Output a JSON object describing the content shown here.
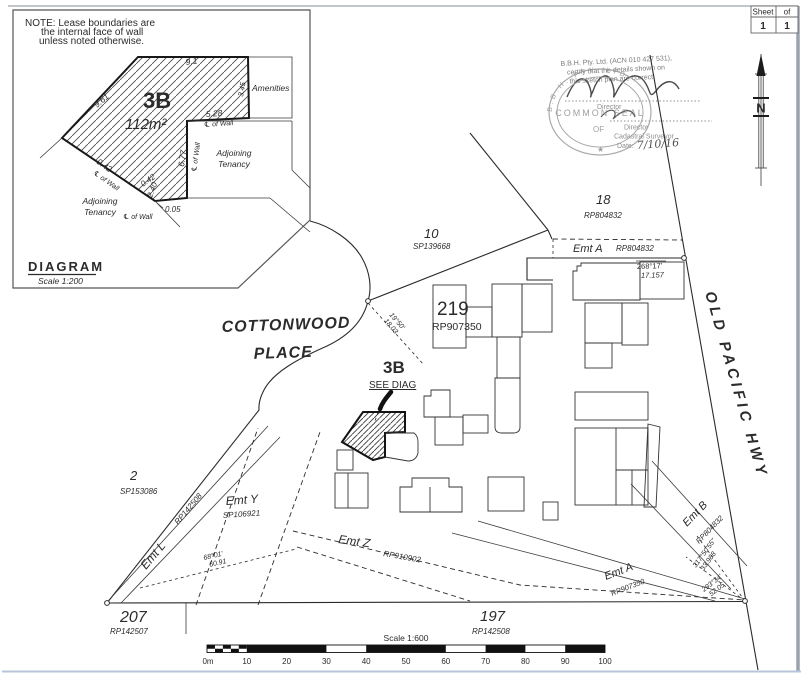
{
  "colors": {
    "drawing_line": "#2b2b2b",
    "stamp_gray": "#8f8f8f",
    "frame_gray": "#9aa3ad",
    "frame_blue": "#b9c6da"
  },
  "sheet": {
    "header1": "Sheet",
    "header2": "of",
    "value1": "1",
    "value2": "1"
  },
  "note": {
    "line1": "NOTE: Lease boundaries are",
    "line2": "the internal face of wall",
    "line3": "unless noted otherwise."
  },
  "inset": {
    "title": "DIAGRAM",
    "scale": "Scale 1:200",
    "lot": "3B",
    "area": "112m²",
    "amenities": "Amenities",
    "adjoining": {
      "l1": "Adjoining",
      "l2": "Tenancy"
    },
    "cl_wall": "℄ of Wall",
    "dims": {
      "d961": "9.61",
      "d91": "9.1",
      "d345": "3.45",
      "d528": "5.28",
      "d677": "6.77",
      "d942": "9.42",
      "d042": "0.42",
      "d240": "2.40",
      "d005": "0.05"
    }
  },
  "stamp": {
    "cert1": "B.B.H. Pty. Ltd. (ACN 010 427 531),",
    "cert2": "certify that the details shown on",
    "cert3": "this sketch plan are correct.",
    "director": "Director",
    "cadastral": "Cadastral Surveyor",
    "date_label": "Date:",
    "date_value": "7/10/16",
    "seal_line1": "COMMON SEAL",
    "seal_line2": "OF",
    "seal_ring": "B.B.H. PTY. LTD.",
    "seal_star": "★"
  },
  "north": {
    "label": "N"
  },
  "plan": {
    "lot10": {
      "num": "10",
      "plan": "SP139668"
    },
    "lot18": {
      "num": "18",
      "plan": "RP804832"
    },
    "emt_a_top": {
      "name": "Emt A",
      "plan": "RP804832"
    },
    "brg_268": {
      "bearing": "268°17'",
      "dist": "17.157"
    },
    "lot219": {
      "num": "219",
      "plan": "RP907350"
    },
    "lot3b": {
      "num": "3B",
      "see": "SEE DIAG"
    },
    "road": {
      "l1": "COTTONWOOD",
      "l2": "PLACE"
    },
    "hwy": "OLD  PACIFIC  HWY",
    "brg_19": {
      "bearing": "19°50'",
      "dist": "18.03"
    },
    "lot2": {
      "num": "2",
      "plan": "SP153086"
    },
    "emt_l": {
      "name": "Emt L",
      "plan": "RP142508"
    },
    "emt_y": {
      "name": "Emt Y",
      "plan": "SP106921"
    },
    "brg_68": {
      "bearing": "68°01'",
      "dist": "60.91"
    },
    "emt_z": {
      "name": "Emt Z",
      "plan": "RP910902"
    },
    "lot207": {
      "num": "207",
      "plan": "RP142507"
    },
    "lot197": {
      "num": "197",
      "plan": "RP142508"
    },
    "emt_b": {
      "name": "Emt B",
      "plan": "RP804832"
    },
    "emt_a_btm": {
      "name": "Emt A",
      "plan": "RP907350"
    },
    "brg_317": {
      "bearing": "317°50'55\"",
      "dist": "33.988"
    },
    "brg_293": {
      "bearing": "293°34'",
      "dist": "52.05"
    }
  },
  "scalebar": {
    "title": "Scale 1:600",
    "ticks": [
      "0m",
      "10",
      "20",
      "30",
      "40",
      "50",
      "60",
      "70",
      "80",
      "90",
      "100"
    ]
  }
}
